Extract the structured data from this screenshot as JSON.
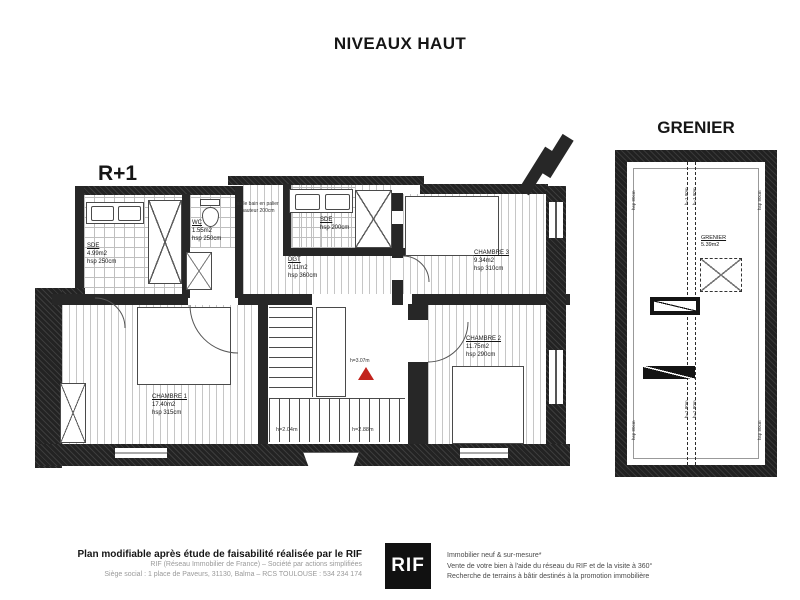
{
  "title": "NIVEAUX HAUT",
  "r1": {
    "label": "R+1",
    "sde1": {
      "name": "SDE",
      "area": "4.99m2",
      "height": "hsp 250cm"
    },
    "wc": {
      "name": "WC",
      "area": "1.55m2",
      "height": "hsp 250cm"
    },
    "note1": "salle bain en palier",
    "note2": "hauteur 200cm",
    "sde2": {
      "name": "SDE",
      "height": "hsp 200cm"
    },
    "dgt": {
      "name": "DGT",
      "area": "9.11m2",
      "height": "hsp 360cm"
    },
    "ch3": {
      "name": "CHAMBRE 3",
      "area": "9.34m2",
      "height": "hsp 310cm"
    },
    "ch2": {
      "name": "CHAMBRE 2",
      "area": "11.75m2",
      "height": "hsp 290cm"
    },
    "ch1": {
      "name": "CHAMBRE 1",
      "area": "17.40m2",
      "height": "hsp 315cm"
    },
    "stairs": {
      "h_left": "h=2.04m",
      "h_right": "h=2.88m",
      "h_marker": "h=3.07m"
    }
  },
  "grenier": {
    "label": "GRENIER",
    "room": {
      "name": "GRENIER",
      "area": "5.39m2"
    },
    "ridge_label": "h=1.80m",
    "edge_label": "hsp 80cm"
  },
  "footer": {
    "left_bold": "Plan modifiable après étude de faisabilité réalisée par le RIF",
    "left_line2": "RIF (Réseau Immobilier de France) – Société par actions simplifiées",
    "left_line3": "Siège social : 1 place de Paveurs, 31130, Balma – RCS TOULOUSE : 534 234 174",
    "logo": "RIF",
    "right_line1": "Immobilier neuf & sur-mesure*",
    "right_line2": "Vente de votre bien à l'aide du réseau du RIF et de la visite à 360°",
    "right_line3": "Recherche de terrains à bâtir destinés à la promotion immobilière"
  },
  "colors": {
    "wall": "#272727",
    "marker_red": "#c2231d",
    "logo_bg": "#111111"
  }
}
